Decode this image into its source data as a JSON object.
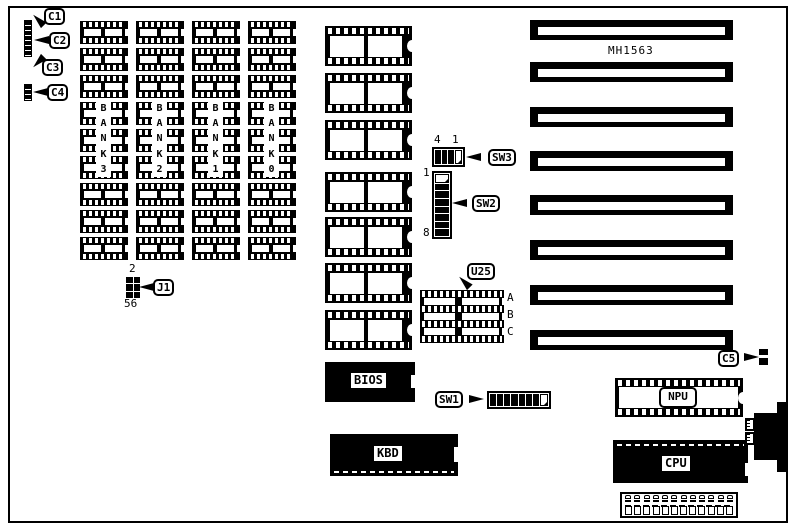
{
  "diagram": {
    "type": "motherboard component layout",
    "model_label": "MH1563",
    "ink_color": "#000000",
    "paper_color": "#ffffff"
  },
  "callouts": {
    "c1": "C1",
    "c2": "C2",
    "c3": "C3",
    "c4": "C4",
    "c5": "C5",
    "j1": "J1",
    "u25": "U25",
    "sw1": "SW1",
    "sw2": "SW2",
    "sw3": "SW3"
  },
  "memory": {
    "banks": [
      {
        "label": "BANK3"
      },
      {
        "label": "BANK2"
      },
      {
        "label": "BANK1"
      },
      {
        "label": "BANK0"
      }
    ],
    "chips_per_bank": 9
  },
  "dip_column": {
    "chip_count": 7
  },
  "expansion_slots": {
    "count": 8
  },
  "chips": {
    "bios_label": "BIOS",
    "kbd_label": "KBD",
    "cpu_label": "CPU",
    "npu_label": "NPU"
  },
  "switches": {
    "sw1": {
      "label": "SW1",
      "positions": 8,
      "states": [
        "on",
        "on",
        "on",
        "on",
        "on",
        "on",
        "on",
        "off"
      ]
    },
    "sw2": {
      "label": "SW2",
      "positions": 8,
      "pin_top_label": "1",
      "pin_bottom_label": "8",
      "states": [
        "off",
        "on",
        "on",
        "on",
        "on",
        "on",
        "on",
        "on"
      ]
    },
    "sw3": {
      "label": "SW3",
      "positions": 4,
      "pin_left_label": "4",
      "pin_right_label": "1",
      "states": [
        "on",
        "on",
        "on",
        "off"
      ]
    }
  },
  "jumpers": {
    "j1": {
      "label": "J1",
      "pin_top_label": "2",
      "pin_bottom_label": "56",
      "rows": 3,
      "cols": 2
    }
  },
  "sockets": {
    "u25": {
      "label": "U25",
      "row_labels": [
        "A",
        "B",
        "C"
      ]
    }
  },
  "bottom_connector": {
    "pin_count": 12,
    "square_count": 12
  }
}
